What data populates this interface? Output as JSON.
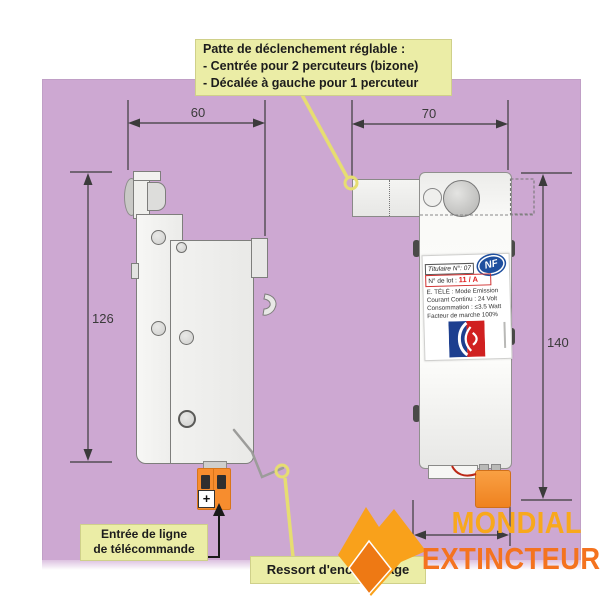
{
  "panel": {
    "color": "#cda8d2"
  },
  "callout_top": {
    "bg": "#ebeda6",
    "lines": [
      "Patte de déclenchement réglable :",
      "- Centrée pour 2 percuteurs (bizone)",
      "- Décalée à gauche pour 1 percuteur"
    ]
  },
  "dimensions": {
    "top_left": "60",
    "top_right": "70",
    "left": "126",
    "right": "140"
  },
  "device_label": {
    "titulaire": "Titulaire N°: 07",
    "lot_label": "N° de lot :",
    "lot_value": "11 / A",
    "nf": "NF",
    "specs": [
      "E. TÉLÉ : Mode Emission",
      "Courant Continu : 24 Volt",
      "Consommation : ≤3.5 Watt",
      "Facteur de marche 100%"
    ]
  },
  "connector": {
    "plus": "+"
  },
  "callout_bottom_left": {
    "lines": [
      "Entrée de ligne",
      "de télécommande"
    ]
  },
  "callout_bottom_mid": {
    "text": "Ressort d'encliquetage"
  },
  "brand": {
    "line1": "MONDIAL",
    "line2": "EXTINCTEUR",
    "color_line1": "#F8A81C",
    "color_line2": "#F4731F"
  },
  "colors": {
    "panel": "#cda8d2",
    "callout_bg": "#ebeda6",
    "dimension_lines": "#3b3b3b",
    "leader_yellow": "#e6dd72",
    "connector_orange": "#F78D2E",
    "nf_blue": "#1f4f9e",
    "lot_red": "#e02020"
  }
}
